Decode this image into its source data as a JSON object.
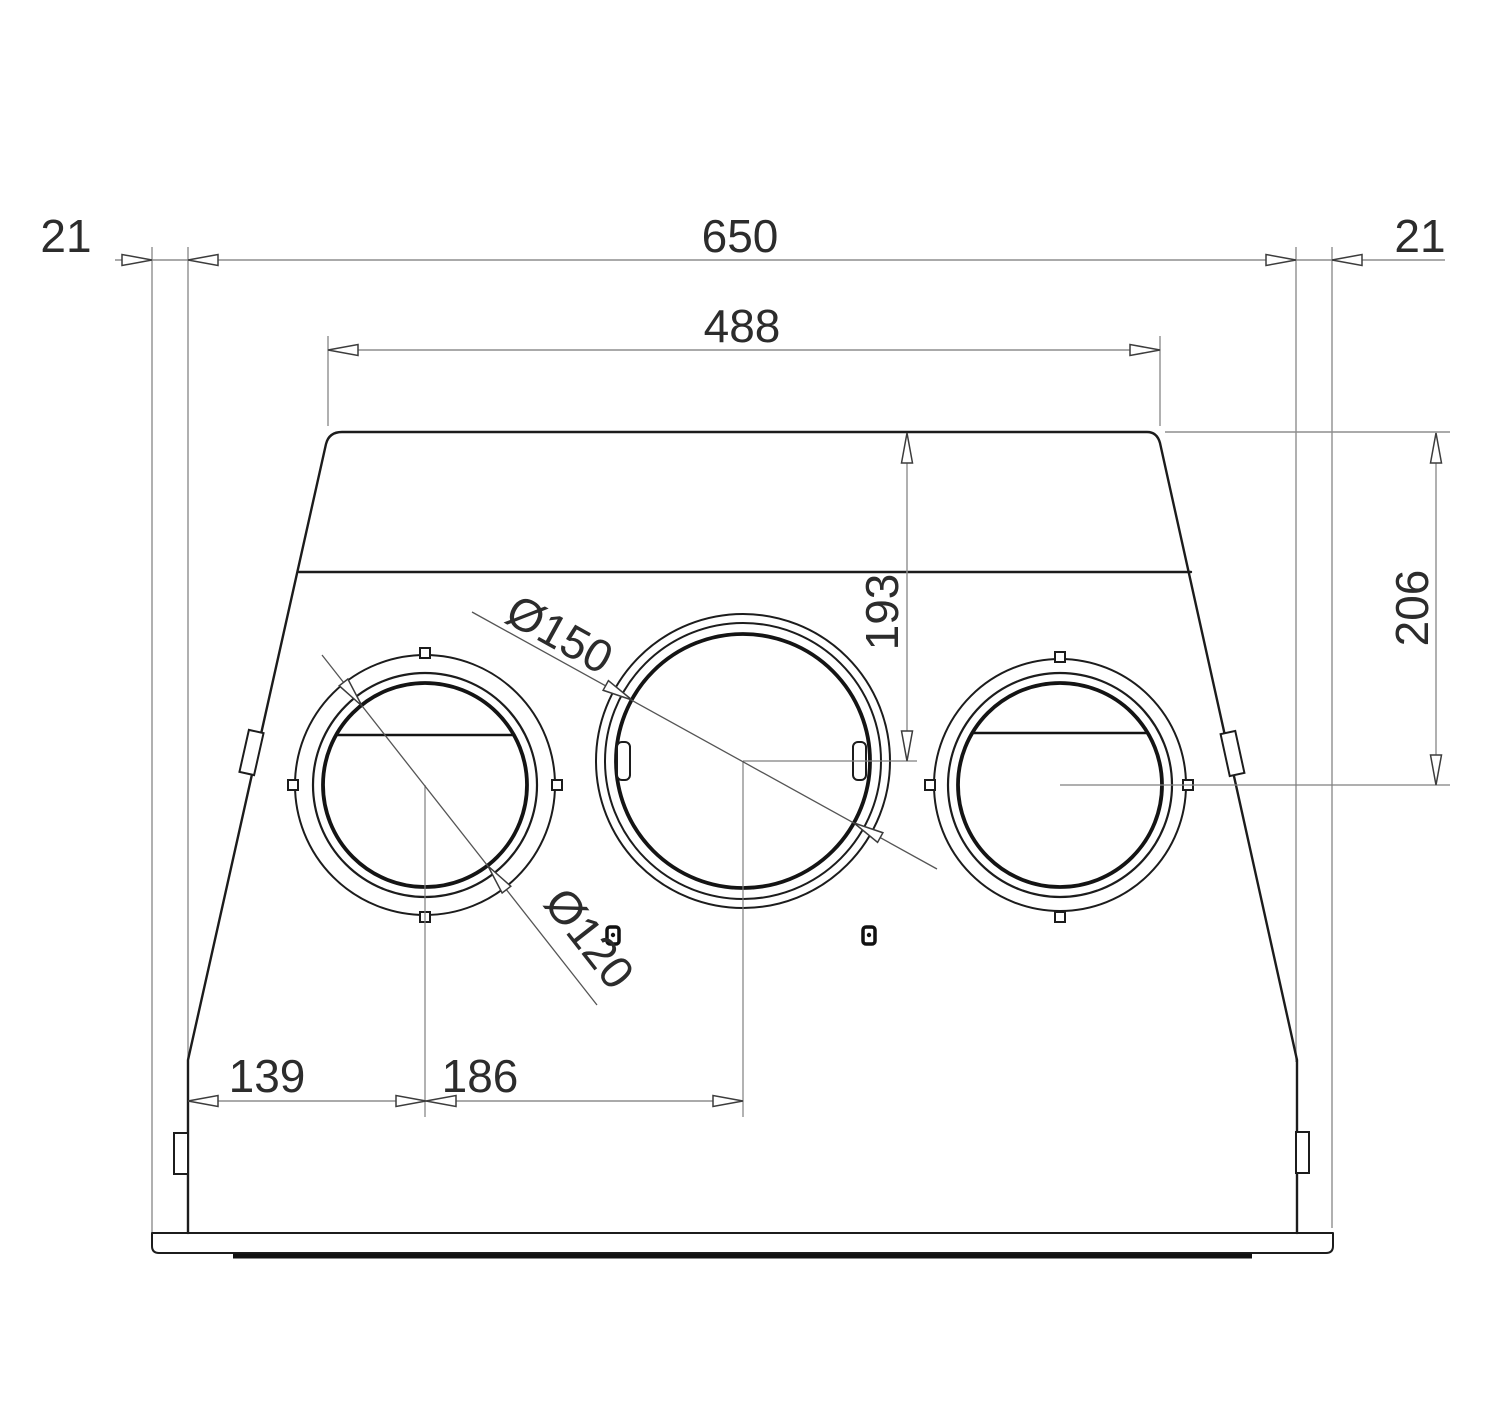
{
  "drawing": {
    "description": "Technical dimension drawing, front view of a ventilation hood plenum with three round duct spigots",
    "labels": {
      "overhang_left": "21",
      "overall_width": "650",
      "overhang_right": "21",
      "top_width": "488",
      "mid_spigot_center_depth": "193",
      "side_spigot_center_depth": "206",
      "left_spigot_offset": "139",
      "spigot_spacing": "186",
      "mid_spigot_diameter": "Ø150",
      "side_spigot_diameter": "Ø120"
    },
    "colors": {
      "background": "#ffffff",
      "object_line": "#1c1c1c",
      "dimension_line": "#8e8e8e",
      "dimension_text": "#2c2c2c"
    }
  }
}
